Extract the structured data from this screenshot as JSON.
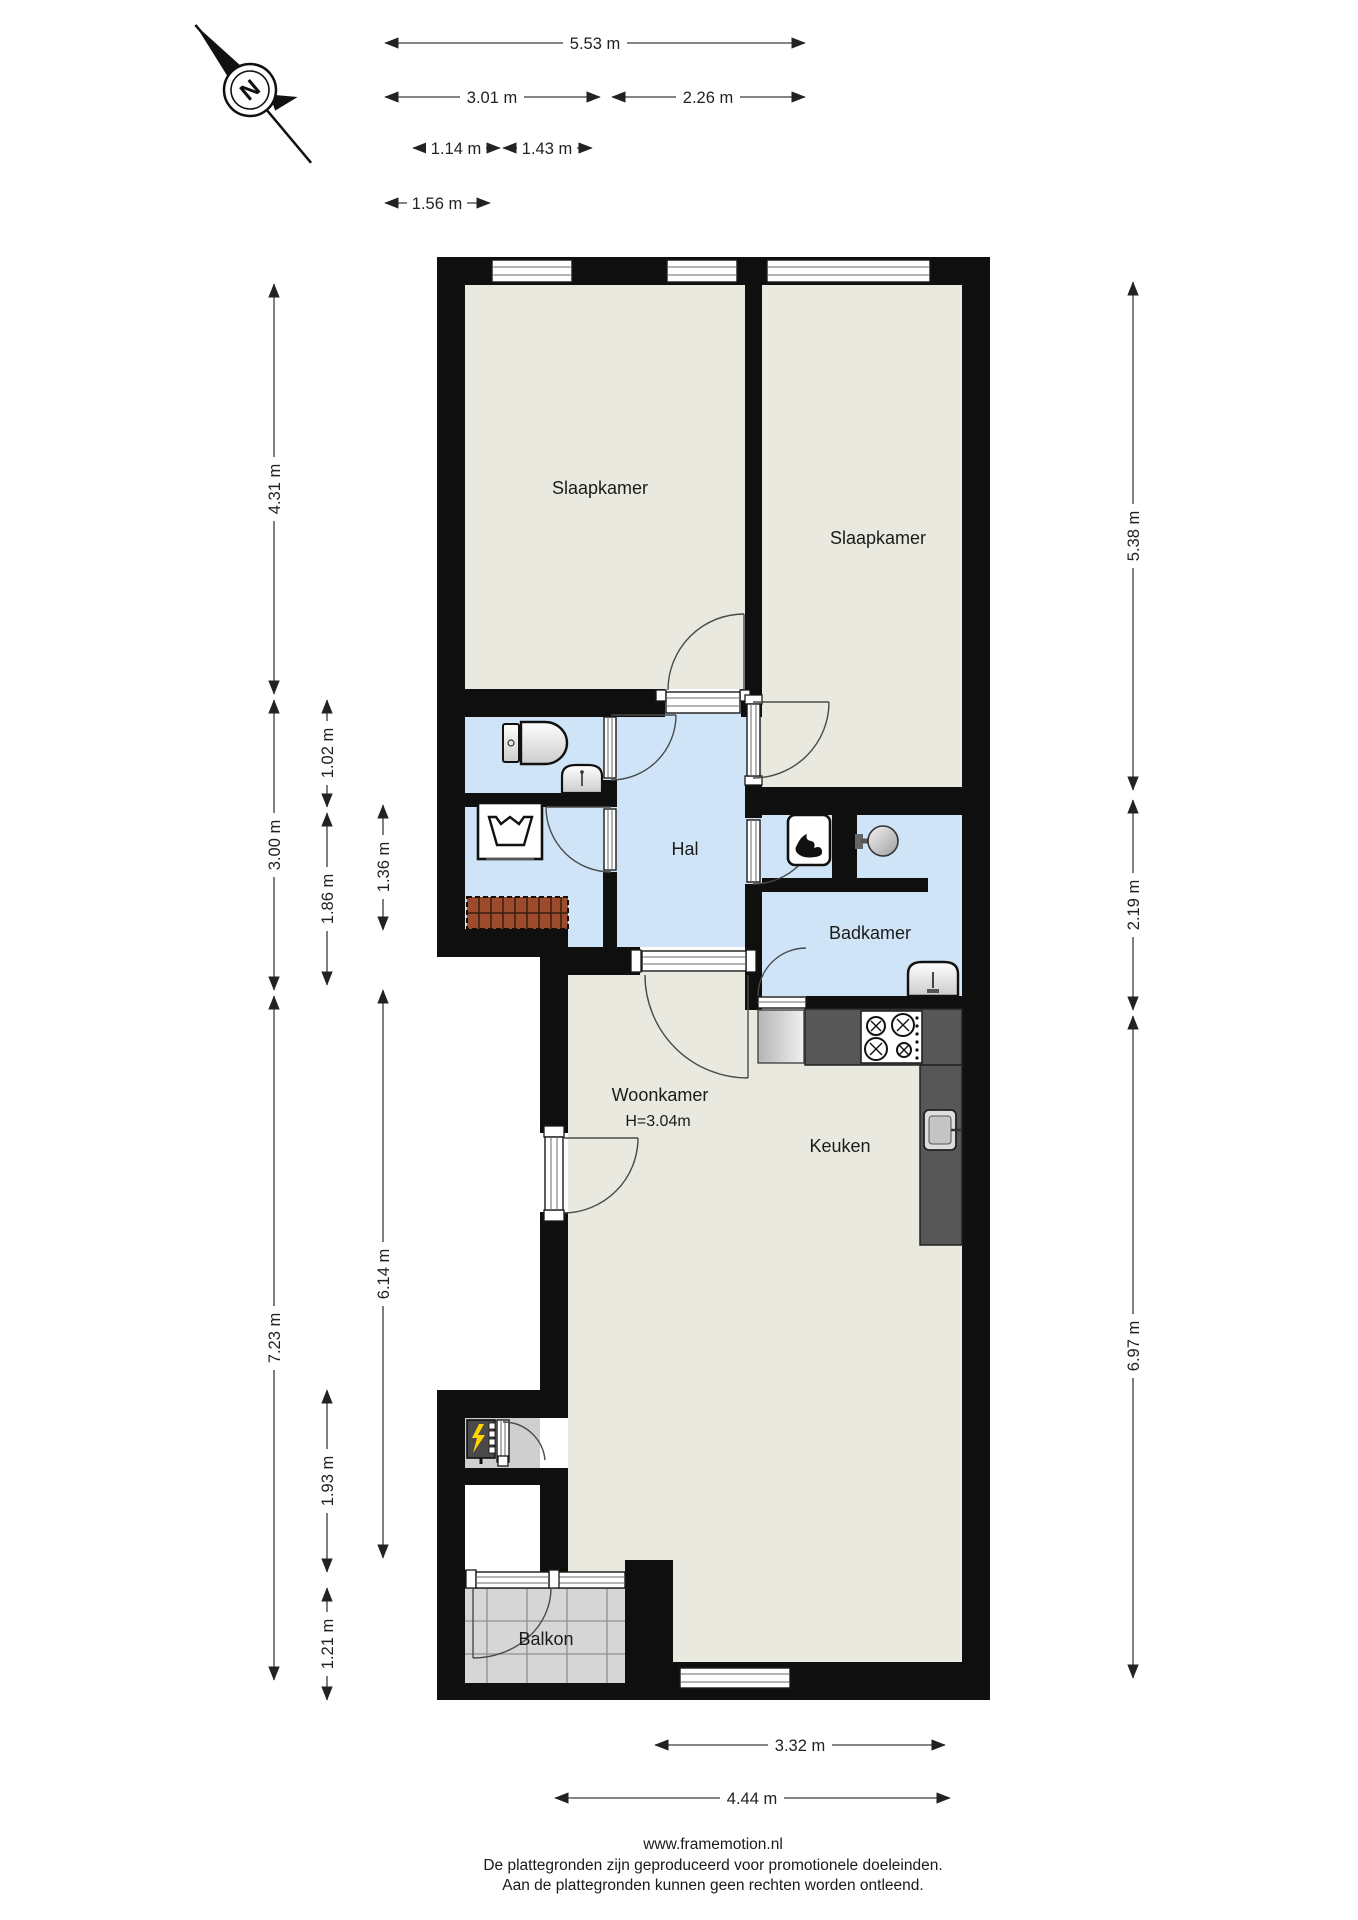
{
  "compass": {
    "letter": "N"
  },
  "rooms": {
    "bedroom1": "Slaapkamer",
    "bedroom2": "Slaapkamer",
    "hall": "Hal",
    "bathroom": "Badkamer",
    "kitchen": "Keuken",
    "living": "Woonkamer",
    "living_height": "H=3.04m",
    "balcony": "Balkon"
  },
  "dims": {
    "d553": "5.53 m",
    "d301": "3.01 m",
    "d226": "2.26 m",
    "d114": "1.14 m",
    "d143": "1.43 m",
    "d156": "1.56 m",
    "d431": "4.31 m",
    "d300": "3.00 m",
    "d723": "7.23 m",
    "d102": "1.02 m",
    "d186": "1.86 m",
    "d193": "1.93 m",
    "d121": "1.21 m",
    "d136": "1.36 m",
    "d614": "6.14 m",
    "d538": "5.38 m",
    "d219": "2.19 m",
    "d697": "6.97 m",
    "d332": "3.32 m",
    "d444": "4.44 m"
  },
  "footer": {
    "site": "www.framemotion.nl",
    "line1": "De plattegronden zijn geproduceerd voor promotionele doeleinden.",
    "line2": "Aan de plattegronden kunnen geen rechten worden ontleend."
  },
  "colors": {
    "wall": "#0f0f0f",
    "floor": "#eae9e0",
    "wet_room": "#cfe5f7",
    "balcony_tile": "#d6d6d6",
    "counter": "#575757",
    "stairs": "#9c4b2d",
    "panel_yellow": "#ffd400"
  }
}
